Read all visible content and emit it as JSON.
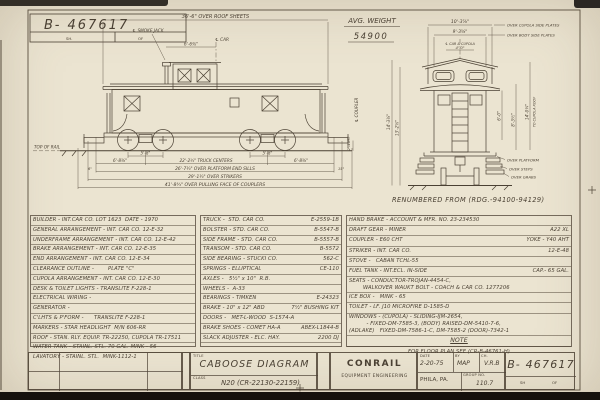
{
  "header": {
    "dwg_no": "B- 467617",
    "sh_label": "SH.",
    "of_label": "OF",
    "avg_weight_label": "AVG. WEIGHT",
    "avg_weight_value": "54900",
    "renumbered": "RENUMBERED FROM (RDG.-94100-94129)"
  },
  "side_dims": {
    "roof_sheets": "36'-6\" OVER ROOF SHEETS",
    "smoke_jack": "℄ SMOKE JACK",
    "cl_car": "℄ CAR",
    "jack_to_cl": "6'-6⅜\"",
    "wb_left": "5'-8\"",
    "wb_right": "5'-8\"",
    "end_left": "6'-8⅜\"",
    "end_right": "6'-8⅜\"",
    "truck_centers": "22'-2½\" TRUCK CENTERS",
    "sills": "26'-7¼\" OVER PLATFORM END SILLS",
    "strikers": "29'-1¼\" OVER STRIKERS",
    "couplers": "41'-8¾\" OVER PULLING FACE OF COUPLERS",
    "six_in": "6\"",
    "fifteen_in": "15\"",
    "top_of_rail": "TOP OF RAIL",
    "cl_coupler": "℄ COUPLER",
    "coupler_ht": "2'-10½\""
  },
  "end_dims": {
    "cupola_plates": "10'-3⅞\"",
    "cupola_plates_label": "OVER CUPOLA SIDE PLATES",
    "body_plates": "9'-3⅝\"",
    "body_plates_label": "OVER BODY SIDE PLATES",
    "cl_car_cupola": "℄ CAR & CUPOLA",
    "four_ft": "4'-0\"",
    "six_ft": "6'-0\"",
    "h_body": "8'-3½\"",
    "h_cupola": "14'-0¼\"",
    "to_cupola_roof": "TO CUPOLA ROOF",
    "h_left1": "14'-3⅛\"",
    "h_left2": "13'-2⅝\"",
    "over_platform": "OVER PLATFORM",
    "over_steps": "OVER STEPS",
    "over_grabs": "OVER GRABS"
  },
  "table": {
    "left": [
      "BUILDER - INT.CAR CO. LOT 1623  DATE - 1970",
      "GENERAL ARRANGEMENT - INT. CAR CO. 12-E-32",
      "UNDERFRAME ARRANGEMENT - INT. CAR CO. 12-E-42",
      "BRAKE ARRANGEMENT - INT. CAR CO. 12-E-35",
      "END ARRANGEMENT - INT. CAR CO. 12-E-34",
      "CLEARANCE OUTLINE -        PLATE \"C\"",
      "CUPOLA ARRANGEMENT - INT. CAR CO. 12-E-30",
      "DESK & TOILET LIGHTS - TRANSLITE F-228-1",
      "ELECTRICAL WIRING -",
      "GENERATOR -",
      "C'LHTS & P'FORM -      TRANSLITE F-228-1",
      "MARKERS - STAR HEADLIGHT  M/N 606-RR",
      "ROOF - STAN. RLY. EQUIP. TR-22250, CUPOLA TR-17511",
      "WATER TANK - STAINL. STL. 70 GAL. MINK - 56",
      "LAVATORY - STAINL. STL.  MINK-1112-1"
    ],
    "middle": [
      {
        "label": "TRUCK -  STD. CAR CO.",
        "value": "E-2559-1B"
      },
      {
        "label": "BOLSTER - STD. CAR CO.",
        "value": "B-5547-B"
      },
      {
        "label": "SIDE FRAME - STD. CAR CO.",
        "value": "B-5557-B"
      },
      {
        "label": "TRANSOM - STD. CAR CO.",
        "value": "B-5572"
      },
      {
        "label": "SIDE BEARING - STUCKI CO.",
        "value": "562-C"
      },
      {
        "label": "SPRINGS - ELLIPTICAL",
        "value": "CE-110"
      },
      {
        "label": "AXLES -   5½\" x 10\"  R.B."
      },
      {
        "label": "WHEELS -  A-33"
      },
      {
        "label": "BEARINGS - TIMKEN",
        "value": "E-24323"
      },
      {
        "label": "BRAKE - 10\" x 12\" ABD",
        "value": "7½\" BUSHING KIT"
      },
      {
        "label": "DOORS -   MET-L-WOOD  S-1574-A"
      },
      {
        "label": "BRAKE SHOES - COMET HA-A",
        "value": "ABEX-L1844-B"
      },
      {
        "label": "SLACK ADJUSTER - ELC. HAY.",
        "value": "2200 DJ"
      }
    ],
    "right": [
      {
        "label": "HAND BRAKE - ACCOUNT & MFR. NO. 23-234530"
      },
      {
        "label": "DRAFT GEAR - MINER",
        "value": "A22 XL"
      },
      {
        "label": "COUPLER - E60 CHT",
        "value": "YOKE - Y40 AHT"
      },
      {
        "label": "STRIKER - INT. CAR CO.",
        "value": "12-E-48"
      },
      {
        "label": "STOVE -   CABAN TCHL-55"
      },
      {
        "label": "FUEL TANK - INT.ECL. IN-SIDE",
        "value": "CAP.- 65 GAL."
      },
      {
        "line1": "SEATS - CONDUCTOR-TROJAN-4454-C,",
        "line2": "WALKOVER WAUKT BOLT - COACH & CAR CO. 1277206"
      },
      {
        "label": "ICE BOX -   MINK - 65"
      },
      {
        "label": "TOILET - LF. J10 MICROFIRE D-1585-D"
      },
      {
        "line1": "WINDOWS - (CUPOLA) - SLIDING-IJM-2654,",
        "line2": "  - FIXED-DM-7585-3, (BODY) RAISED-DM-5410-7-6,",
        "line3": "(ADLAKE)   FIXED-DM-7586-1-C, DM-7585-2 (DOOR)-7342-1"
      }
    ]
  },
  "note": {
    "heading": "NOTE",
    "text": "FOR FLOOR PLAN SEE (CR-B-46761-H)"
  },
  "title_block": {
    "title_label": "TITLE",
    "title": "CABOOSE DIAGRAM",
    "class_label": "CLASS",
    "class_value": "N20 (CR-22130-22159)",
    "company": "CONRAIL",
    "department": "EQUIPMENT ENGINEERING",
    "office": "PHILA, PA.",
    "date_label": "DATE",
    "date": "2-20-75",
    "by_label": "BY",
    "by": "MAP",
    "ch_label": "CH.",
    "checked": "V.R.B",
    "group_label": "GROUP NO.",
    "group": "110.7",
    "dwg_no": "B- 467617",
    "sh_label": "SH",
    "of_label": "OF"
  }
}
